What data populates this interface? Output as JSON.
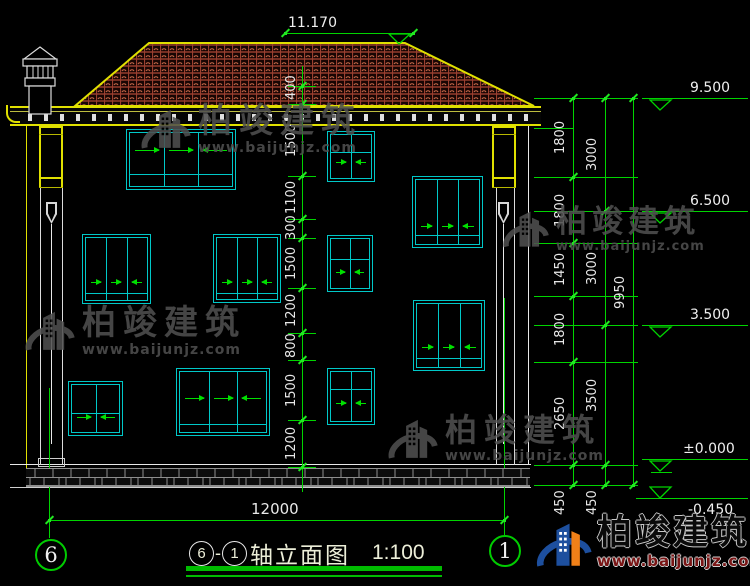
{
  "drawing": {
    "title": {
      "axis_left": "6",
      "axis_right": "1",
      "name": "轴立面图",
      "separator": "-",
      "scale": "1:100"
    },
    "bubbles": {
      "left": "6",
      "right": "1"
    },
    "dims": {
      "top_elevation": "11.170",
      "overall_width": "12000",
      "overall_height": "9950",
      "mid": [
        "400",
        "1500",
        "1100",
        "300",
        "1500",
        "1200",
        "800",
        "1500",
        "1200"
      ],
      "right_inner": [
        "1800",
        "1800",
        "1450",
        "1800",
        "2650",
        "450"
      ],
      "right_outer": [
        "3000",
        "3000",
        "3500",
        "450"
      ],
      "levels": [
        "9.500",
        "6.500",
        "3.500",
        "±0.000",
        "-0.450"
      ]
    },
    "colors": {
      "line_green": "#00d400",
      "cad_cyan": "#00c8c8",
      "cad_yellow": "#e0e000",
      "roof_red": "#a84434",
      "logo_blue": "#1d4f9e",
      "logo_orange": "#f08018",
      "watermark_grey": "#4f4f4f",
      "url_red": "#7a1515"
    }
  },
  "watermark": {
    "brand": "柏竣建筑",
    "url": "www.baijunjz.com"
  }
}
